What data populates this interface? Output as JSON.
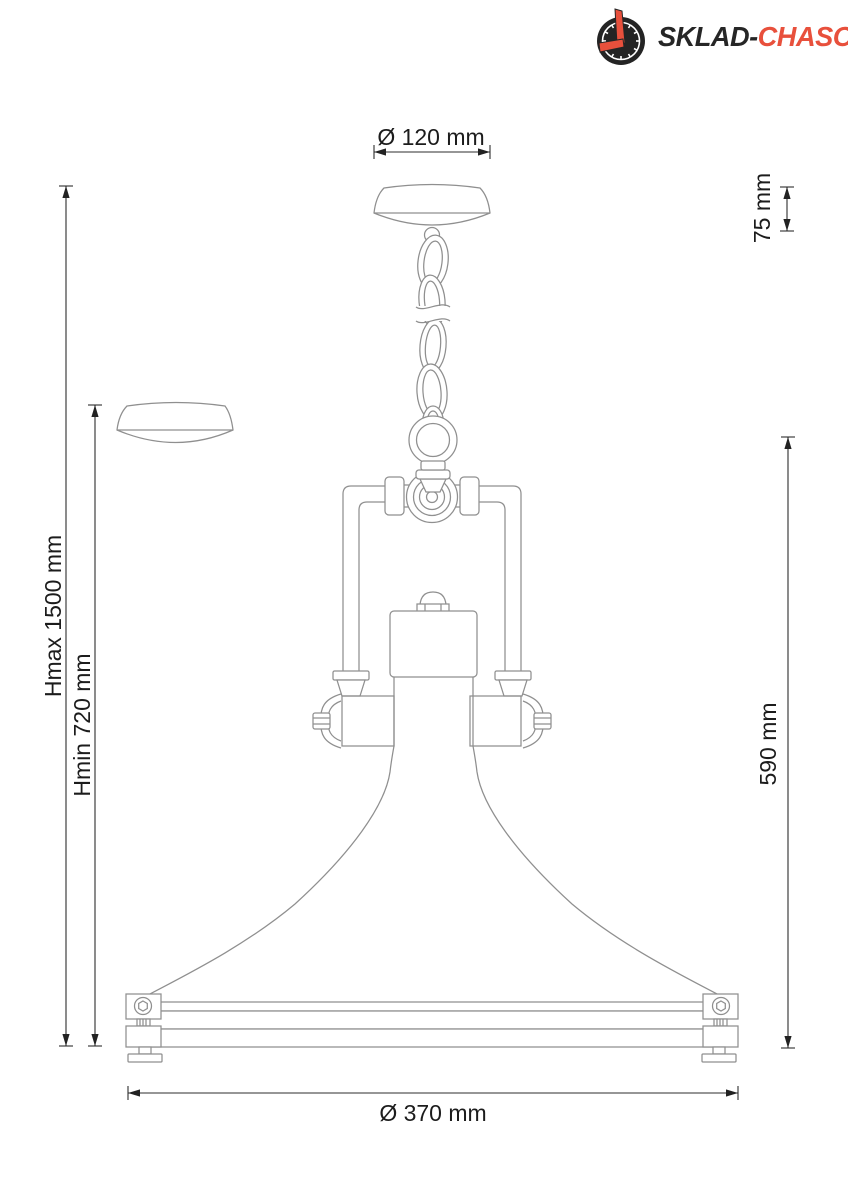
{
  "page": {
    "background": "#ffffff",
    "description": "Pendant lamp dimensional technical drawing"
  },
  "logo": {
    "icon": "clock-icon",
    "text_dark": "SKLAD-",
    "text_red": "CHASOV",
    "color_dark": "#262626",
    "color_red": "#e8503c"
  },
  "drawing": {
    "line_color": "#8f8f8f",
    "dimension_line_color": "#2d2d2d",
    "label_color": "#1c1c1c",
    "dimensions": {
      "canopy_diameter": "Ø 120 mm",
      "canopy_height": "75 mm",
      "max_height": "Hmax 1500 mm",
      "min_height": "Hmin 720 mm",
      "lamp_height": "590 mm",
      "shade_diameter": "Ø 370 mm"
    }
  }
}
